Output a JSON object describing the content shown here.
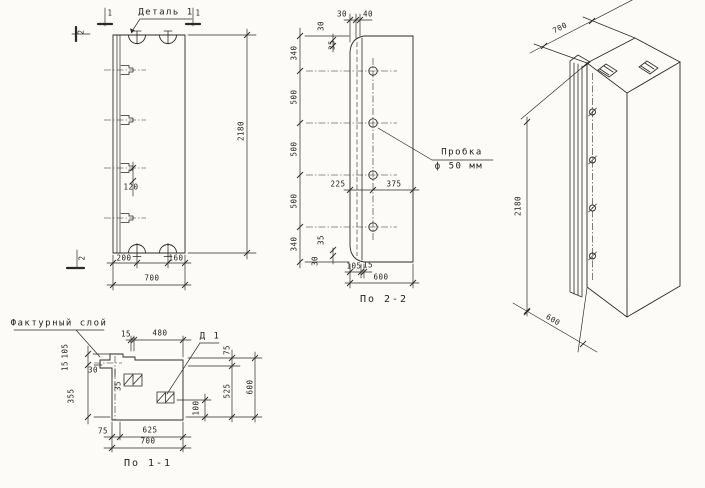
{
  "drawing": {
    "front": {
      "detail_label": "Деталь 1",
      "mark_1": "1",
      "mark_2": "2",
      "dim_clip": "120",
      "dim_height": "2180",
      "dim_loop_left": "200",
      "dim_loop_right": "160",
      "dim_width": "700"
    },
    "section22": {
      "title": "По 2-2",
      "dim_top_30": "30",
      "dim_top_40": "40",
      "dim_rib_top_30": "30",
      "dim_rib_top_35": "35",
      "chain": [
        "340",
        "500",
        "500",
        "500",
        "340"
      ],
      "dim_rib_bot_35": "35",
      "dim_rib_bot_30": "30",
      "dim_mid_left": "225",
      "dim_mid_right": "375",
      "dim_bot_105": "105",
      "dim_bot_15": "15",
      "dim_depth": "600",
      "plug_note_line1": "Пробка",
      "plug_note_line2": "ф 50 мм"
    },
    "iso": {
      "dim_width": "700",
      "dim_height": "2180",
      "dim_depth": "600"
    },
    "section11": {
      "title": "По 1-1",
      "surface_label": "Фактурный слой",
      "part_label": "Д 1",
      "dim_top_15": "15",
      "dim_top_480": "480",
      "dim_left_105": "105",
      "dim_left_15": "15",
      "dim_left_355": "355",
      "dim_left_30": "30",
      "dim_left_35": "35",
      "dim_right_75": "75",
      "dim_right_525": "525",
      "dim_right_600": "600",
      "dim_right_100": "100",
      "dim_bot_75": "75",
      "dim_bot_625": "625",
      "dim_bot_700": "700"
    }
  },
  "colors": {
    "line": "#2a2a27",
    "bg": "#fcfbf8"
  }
}
